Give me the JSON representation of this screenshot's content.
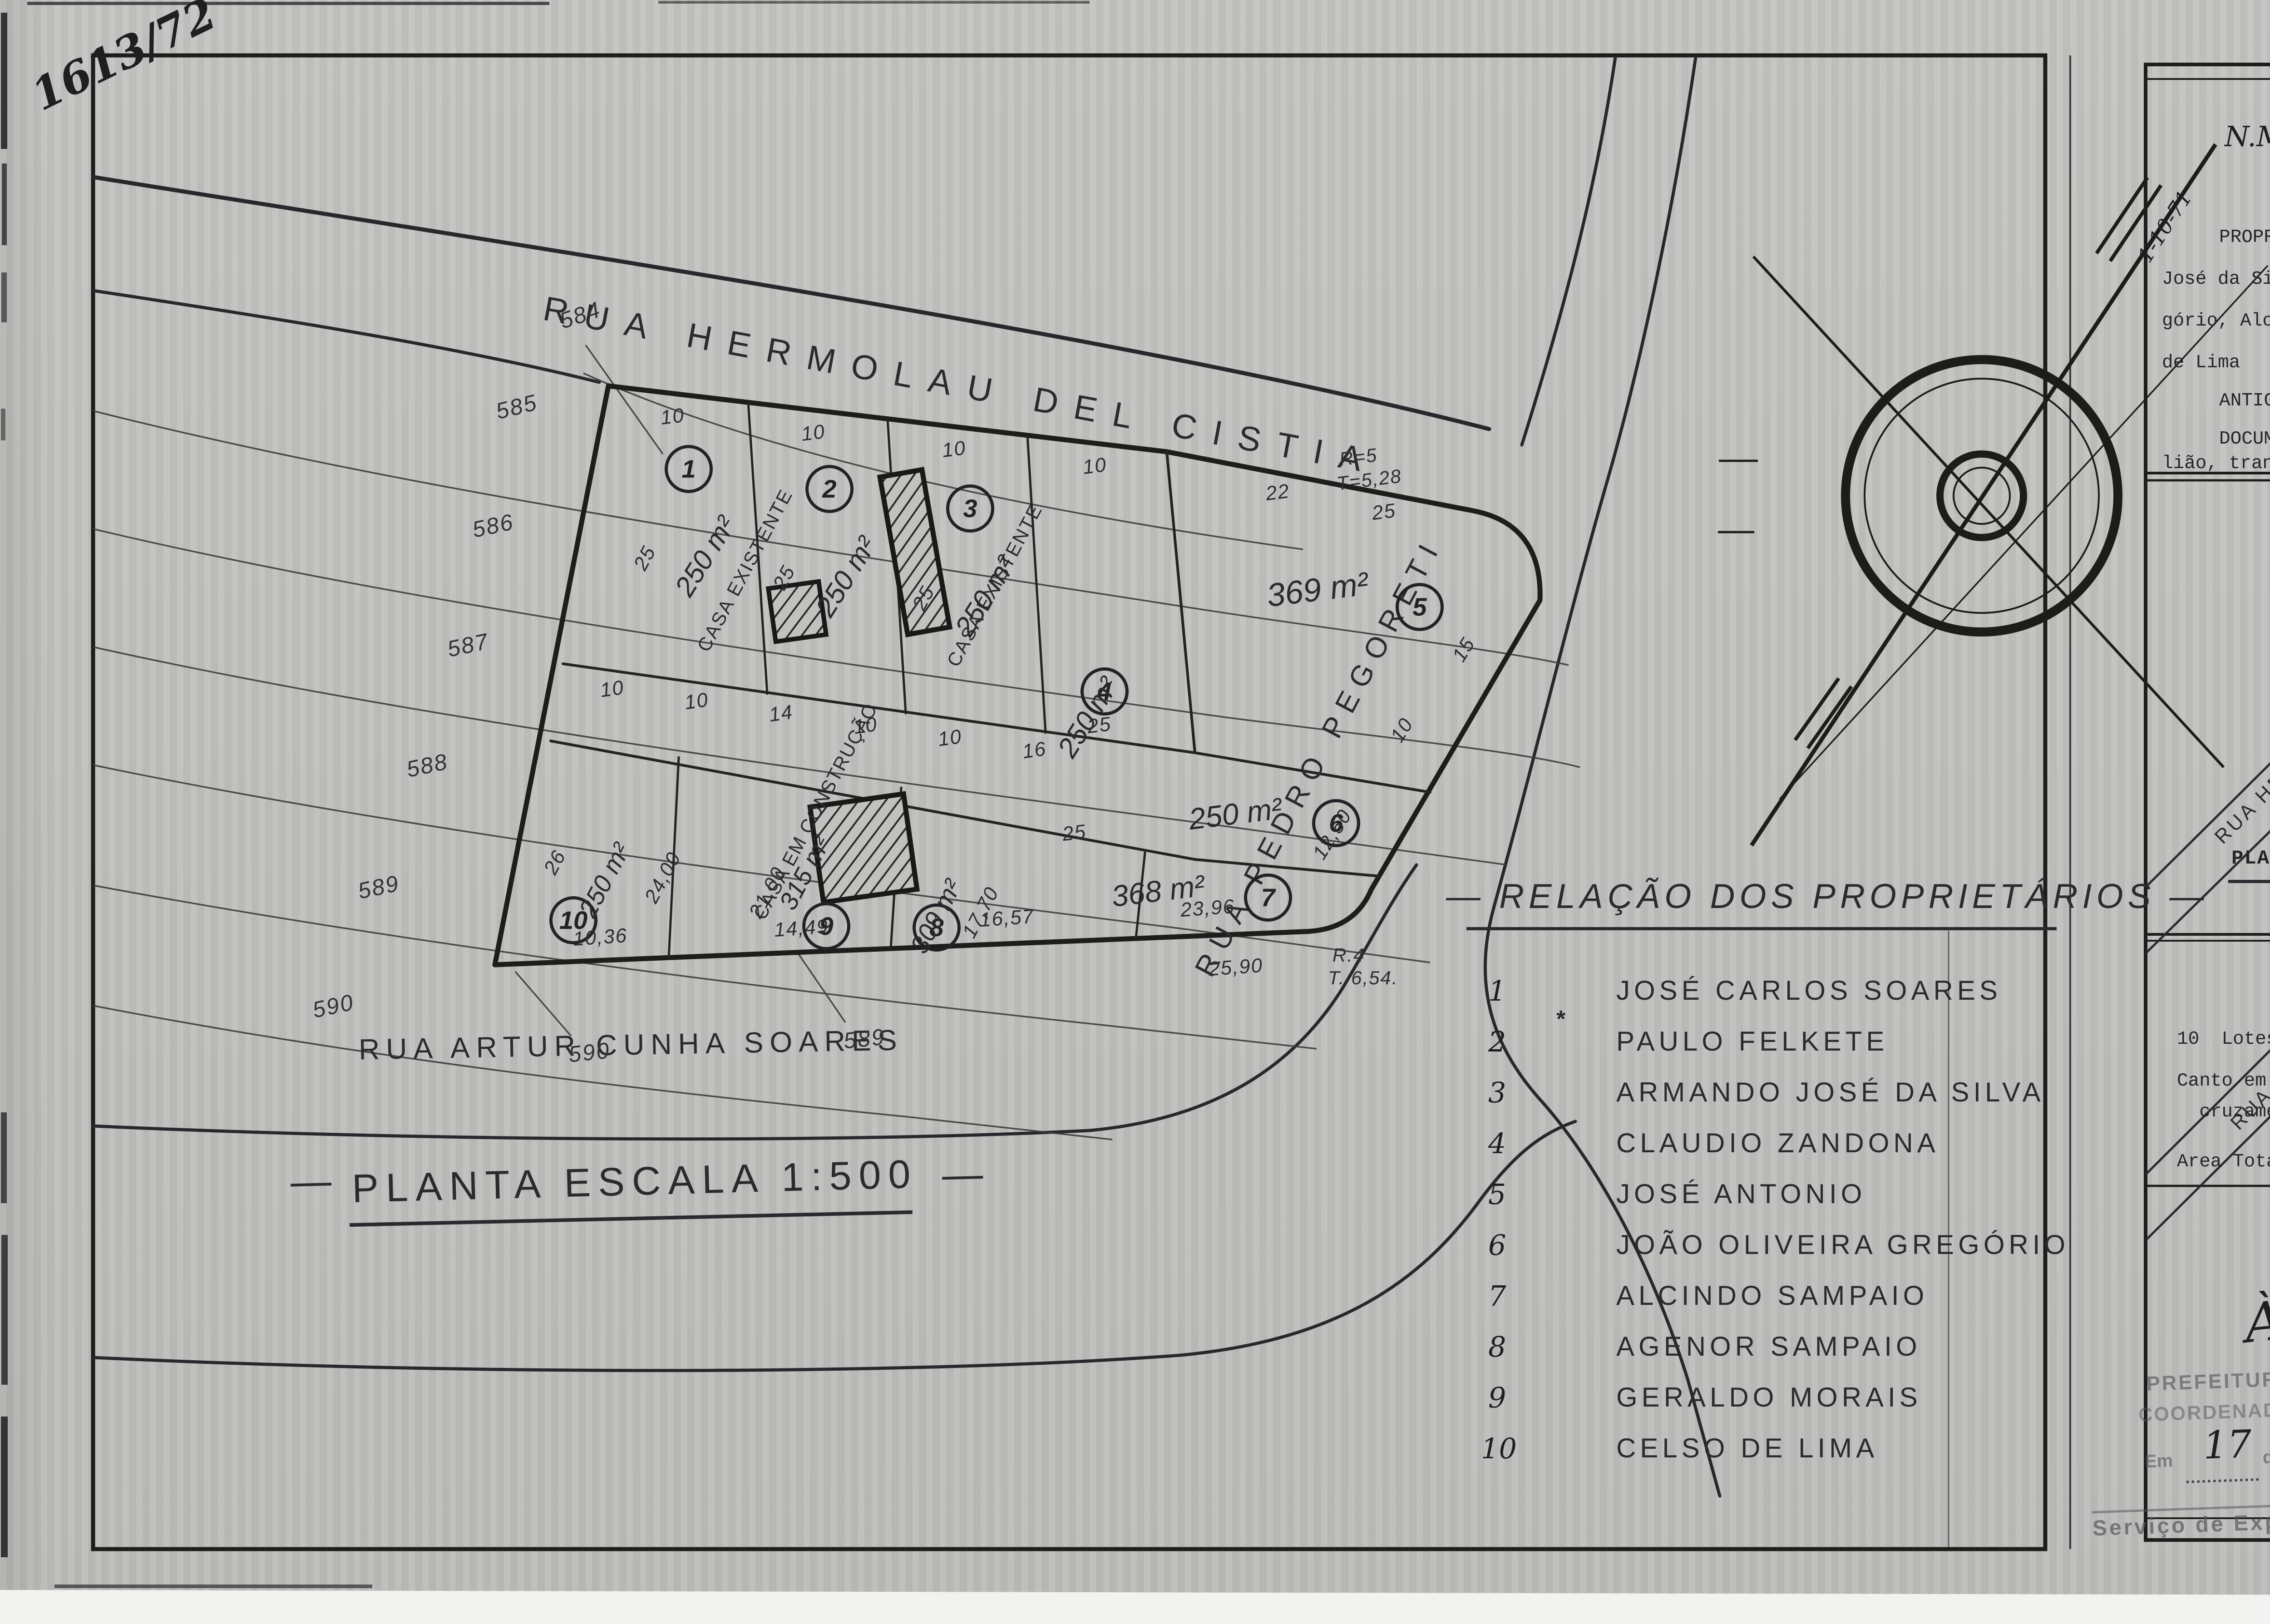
{
  "corner": {
    "file_no": "1613/72",
    "page_no": "238",
    "locality": "VL. ARACELIS."
  },
  "plan": {
    "street_top": "RUA HERMOLAU DEL CISTIA",
    "street_right": "RUA PEDRO PEGORETI",
    "street_bottom": "RUA ARTUR CUNHA SOARES",
    "scale_title": "PLANTA ESCALA 1:500",
    "scale_dash": "—",
    "compass": {
      "nm": "N.M",
      "nv": "N.V",
      "date": "1-10-71"
    },
    "curve_top": {
      "r": "R=5",
      "t": "T=5,28"
    },
    "curve_bottom": {
      "r": "R.4",
      "t": "T. 6,54."
    },
    "elevations": [
      "584",
      "585",
      "586",
      "587",
      "588",
      "589",
      "590",
      "590",
      "589"
    ],
    "lots": [
      {
        "n": "1",
        "area": "250 m²"
      },
      {
        "n": "2",
        "area": "250 m²"
      },
      {
        "n": "3",
        "area": "250 m²"
      },
      {
        "n": "4",
        "area": "250 m²"
      },
      {
        "n": "5",
        "area": "369 m²"
      },
      {
        "n": "6",
        "area": "250 m²"
      },
      {
        "n": "7",
        "area": "368 m²"
      },
      {
        "n": "8",
        "area": "309 m²"
      },
      {
        "n": "9",
        "area": "315 m²"
      },
      {
        "n": "10",
        "area": "250 m²"
      }
    ],
    "buildings": {
      "existing": "CASA EXISTENTE",
      "construction": "CASA EM CONSTRUÇÃO"
    },
    "dims": {
      "top": [
        "10",
        "10",
        "10",
        "10",
        "22",
        "25"
      ],
      "right": [
        "15",
        "10",
        "12,50",
        "25",
        "25"
      ],
      "mid": [
        "10",
        "10",
        "14",
        "10",
        "10",
        "16"
      ],
      "left": [
        "25",
        "25",
        "25",
        "26",
        "24,00",
        "21,00",
        "17,70"
      ],
      "bottom": [
        "10,36",
        "14,49",
        "16,57",
        "23,96",
        "25,90"
      ]
    }
  },
  "owners": {
    "title": "— RELAÇÃO DOS PROPRIETÁRIOS —",
    "asterisk": "*",
    "items": [
      {
        "n": "1",
        "name": "JOSÉ CARLOS SOARES"
      },
      {
        "n": "2",
        "name": "PAULO FELKETE"
      },
      {
        "n": "3",
        "name": "ARMANDO JOSÉ DA SILVA"
      },
      {
        "n": "4",
        "name": "CLAUDIO ZANDONA"
      },
      {
        "n": "5",
        "name": "JOSÉ ANTONIO"
      },
      {
        "n": "6",
        "name": "JOÃO OLIVEIRA GREGÓRIO"
      },
      {
        "n": "7",
        "name": "ALCINDO SAMPAIO"
      },
      {
        "n": "8",
        "name": "AGENOR SAMPAIO"
      },
      {
        "n": "9",
        "name": "GERALDO MORAIS"
      },
      {
        "n": "10",
        "name": "CELSO DE LIMA"
      }
    ]
  },
  "panel": {
    "folha": "FOLHA ÚNICA",
    "via": "VIA",
    "title": "---- PLANTA PARA LEGALIZAÇÃO DE LOTEAMENTO ----",
    "prop_lines": [
      "PROPRITÁRIOS:-  José Carlos Soares, Paulo Felkete, Armando",
      "José da Silva, Claudio Zandona, José Antonio, João Oliveira Gre-",
      "gório, Alcindo Sampaio, Agenor Sampaio, Geraldo Morais e Celso",
      "de Lima"
    ],
    "antigo": "ANTIGO PROPRIETÁRIO:  Dra. Aracelis Rodrigues Peterson",
    "doc_lines": [
      "DOCUMENTO DE PROPRIEDADE:   Escritura pública do 1º Tabe-",
      "lião, transcrita no Cartorio da 1º Circunscrição."
    ],
    "map": {
      "label": "PLANTA PARA LOCALIZAÇÃO",
      "local": "LOCAL",
      "nv": "N.V",
      "s1a": "RUA HERMOLAU",
      "s1b": "DEL",
      "s1c": "CISTIA",
      "s2a": "RUA PEDRO",
      "s2b": "PEGORETI",
      "s3": "RUA ARTUR CUNHA SOARES"
    },
    "areas": {
      "title": "A R E A S",
      "r1": "10  Lotes...........2.861,00 m2",
      "r2a": "Canto em curva nos",
      "r2b": "  cruzamentos.......    15,00 m2",
      "r3": "Area Total..........2.876,00 m2"
    },
    "decl": {
      "lines": [
        "Declaro que a aprovação",
        "desta planta não implica a Pre-",
        "feitura no reconhecimento  do",
        "direito de propriedade do ter-",
        "reno."
      ],
      "sig": "Aracelis Rodrigues Peterson",
      "role": "PROPRIETARIO"
    },
    "author": {
      "label": "AUTOR DO PROJETO",
      "crea": "ENG.  CREA  22927/D - 6ªR.",
      "art": "ART.  Nº 041492  SÉRIE A"
    },
    "approval": {
      "org1": "PREFEITURA DO MUNICÍPIO DE SOROCABA",
      "org2": "COORDENADORIA DE OBRAS E URBANISMO",
      "proc_label": "PROC. N.o",
      "proc_no": "3162/71.",
      "status": "A P R O V A D O",
      "alvara": "ALVARÁ",
      "expedido": "EXPEDIDO EM",
      "date": "14 | 08 | 72"
    },
    "topo": {
      "heading": "À Topografia",
      "org1": "PREFEITURA MUNICIPAL DE SOROCABA",
      "org2": "COORDENADORIA DE OBRAS E URBANISMO",
      "em": "Em",
      "de": "de",
      "de19": "de 19",
      "day": "17",
      "month": "agosto",
      "year": "72",
      "footer": "Serviço de Expediente Seccional"
    }
  }
}
